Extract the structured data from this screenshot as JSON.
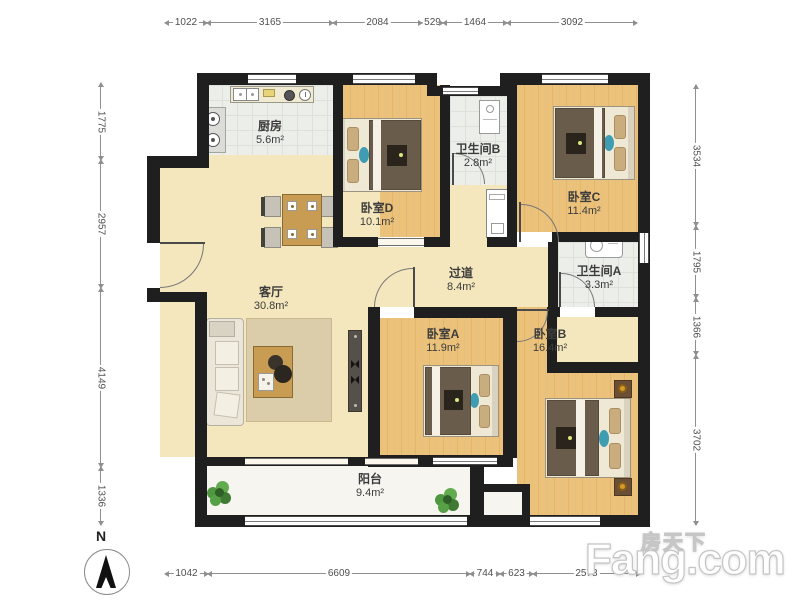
{
  "compass": {
    "label": "N"
  },
  "watermark": {
    "cn": "房天下",
    "en": "Fang.com"
  },
  "rooms": {
    "kitchen": {
      "name": "厨房",
      "area": "5.6m²"
    },
    "bedroom_d": {
      "name": "卧室D",
      "area": "10.1m²"
    },
    "bathroom_b": {
      "name": "卫生间B",
      "area": "2.8m²"
    },
    "bedroom_c": {
      "name": "卧室C",
      "area": "11.4m²"
    },
    "living_room": {
      "name": "客厅",
      "area": "30.8m²"
    },
    "hallway": {
      "name": "过道",
      "area": "8.4m²"
    },
    "bathroom_a": {
      "name": "卫生间A",
      "area": "3.3m²"
    },
    "bedroom_a": {
      "name": "卧室A",
      "area": "11.9m²"
    },
    "bedroom_b": {
      "name": "卧室B",
      "area": "16.4m²"
    },
    "balcony": {
      "name": "阳台",
      "area": "9.4m²"
    }
  },
  "dimensions_mm": {
    "top": [
      "1022",
      "3165",
      "2084",
      "529",
      "1464",
      "3092"
    ],
    "bottom": [
      "1042",
      "6609",
      "744",
      "623",
      "2578"
    ],
    "left": [
      "1775",
      "2957",
      "4149",
      "1336"
    ],
    "right": [
      "3534",
      "1795",
      "1366",
      "3702"
    ]
  },
  "icons": {
    "compass": "compass-north-icon",
    "plants": "potted-plant-icon",
    "sink": "kitchen-sink-icon",
    "stove": "stove-burners-icon",
    "washer": "washing-machine-icon"
  },
  "colors": {
    "wall": "#1f1f1f",
    "wood_floor": "#ecc27b",
    "tile_floor": "#eceee9",
    "living_floor": "#f4e7bd",
    "furniture_wood": "#c99c54",
    "duvet": "#6a5c4b",
    "accent_teal": "#3e9cb3",
    "plant_green": "#4f9840"
  }
}
